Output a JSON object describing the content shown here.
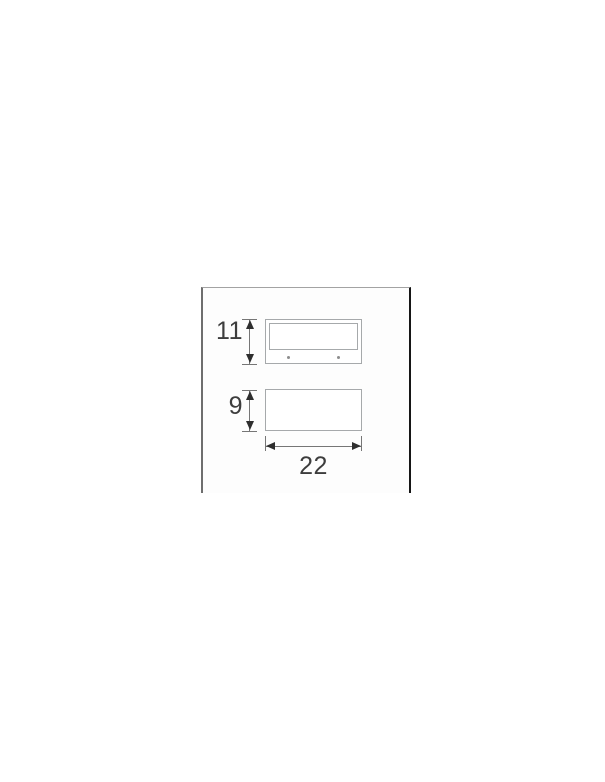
{
  "diagram": {
    "type": "product-dimension-drawing",
    "front_view": {
      "height_label": "11",
      "screw_dot_count": 2
    },
    "side_view": {
      "height_label": "9",
      "width_label": "22"
    },
    "dimensions": {
      "front_height_units": 11,
      "side_height_units": 9,
      "width_units": 22
    },
    "colors": {
      "outline": "#a6a9ab",
      "dimension_line": "#767676",
      "arrowhead": "#2e2e2e",
      "label_text": "#3d3d3d",
      "panel_border_left": "#6e6e6e",
      "panel_border_top": "#a3a3a3",
      "panel_border_right": "#161616",
      "background": "#ffffff"
    }
  }
}
